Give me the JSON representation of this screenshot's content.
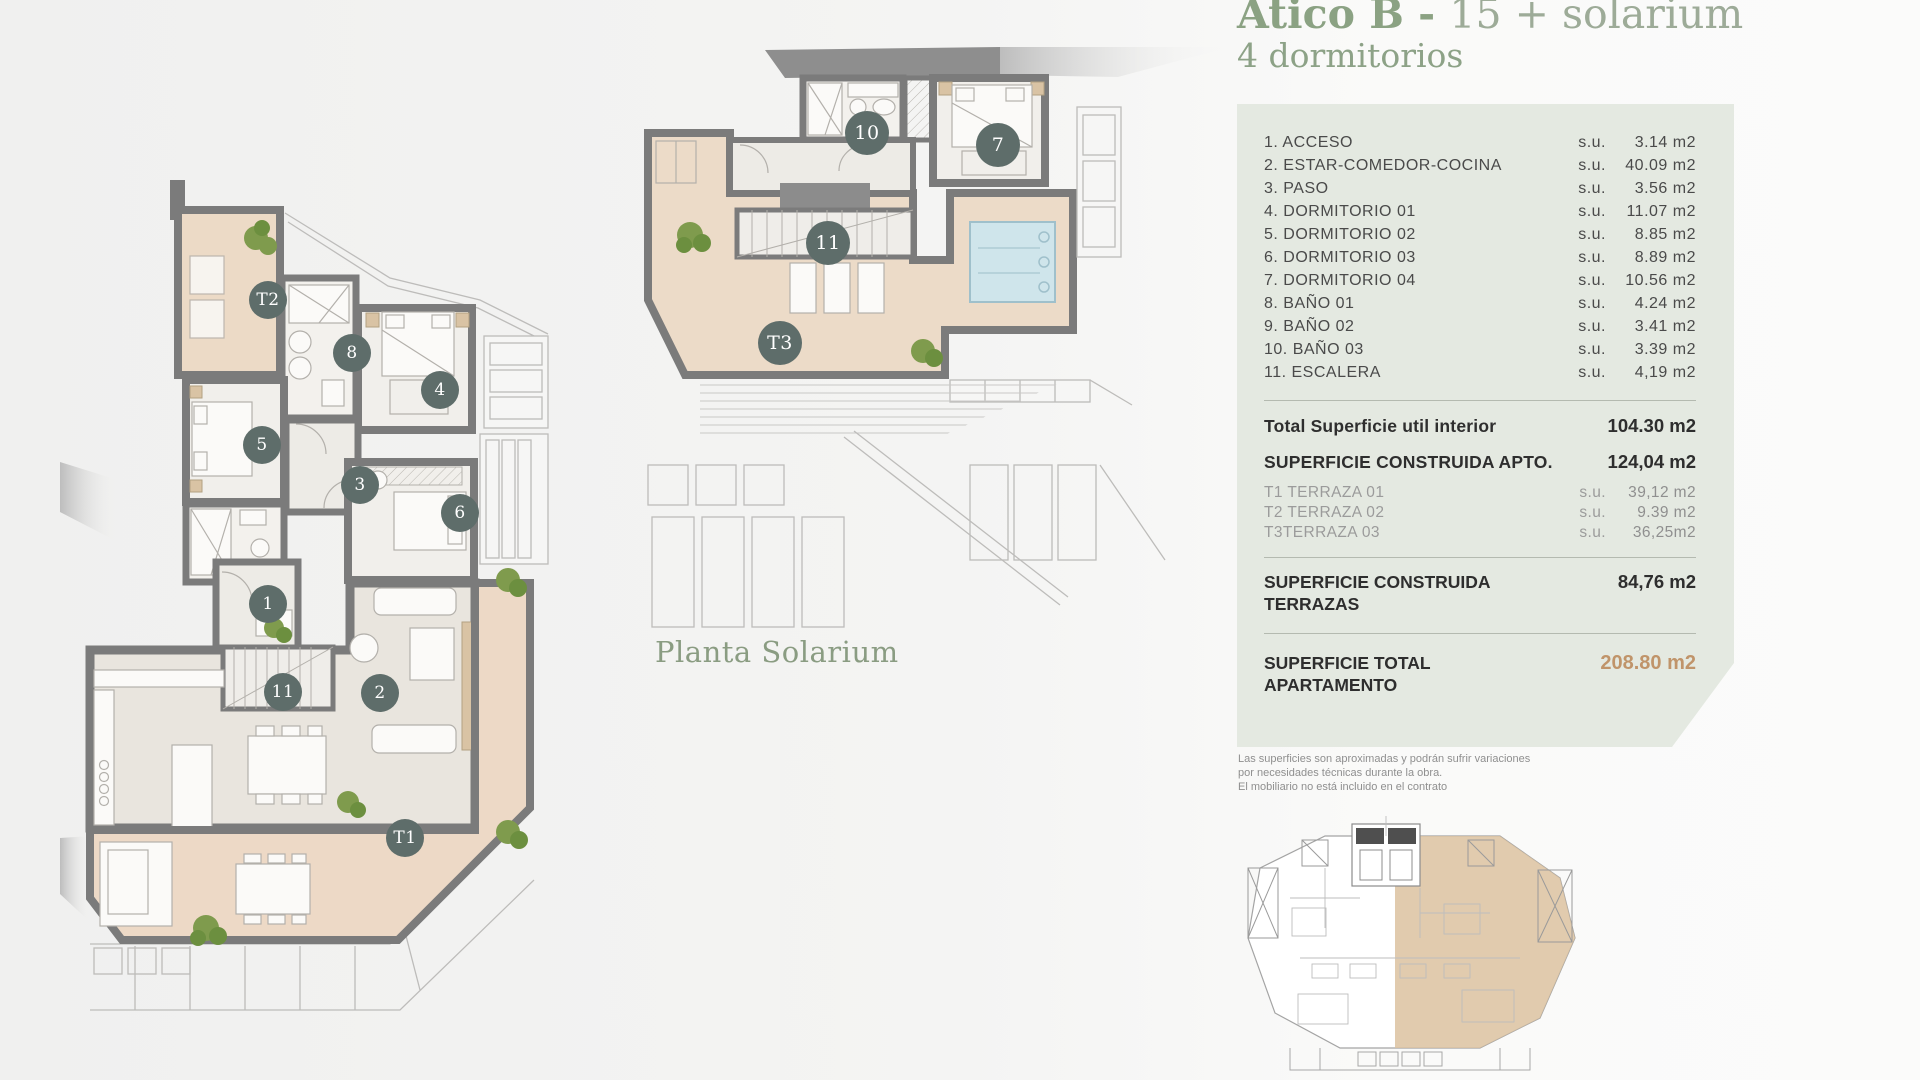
{
  "header": {
    "title_bold": "Ático B - ",
    "title_rest": "15 + solarium",
    "subtitle": "4 dormitorios"
  },
  "plans": {
    "main": {
      "markers": [
        "T2",
        "8",
        "4",
        "5",
        "3",
        "6",
        "1",
        "11",
        "2",
        "T1"
      ]
    },
    "solarium": {
      "caption": "Planta Solarium",
      "markers": [
        "10",
        "7",
        "11",
        "T3"
      ]
    }
  },
  "panel": {
    "rooms": [
      {
        "label": "1. ACCESO",
        "su": "s.u.",
        "value": "3.14 m2"
      },
      {
        "label": "2. ESTAR-COMEDOR-COCINA",
        "su": "s.u.",
        "value": "40.09 m2"
      },
      {
        "label": "3. PASO",
        "su": "s.u.",
        "value": "3.56 m2"
      },
      {
        "label": "4. DORMITORIO 01",
        "su": "s.u.",
        "value": "11.07 m2"
      },
      {
        "label": "5. DORMITORIO 02",
        "su": "s.u.",
        "value": "8.85 m2"
      },
      {
        "label": "6. DORMITORIO 03",
        "su": "s.u.",
        "value": "8.89 m2"
      },
      {
        "label": "7. DORMITORIO 04",
        "su": "s.u.",
        "value": "10.56 m2"
      },
      {
        "label": "8. BAÑO 01",
        "su": "s.u.",
        "value": "4.24 m2"
      },
      {
        "label": "9. BAÑO 02",
        "su": "s.u.",
        "value": "3.41 m2"
      },
      {
        "label": "10. BAÑO 03",
        "su": "s.u.",
        "value": "3.39 m2"
      },
      {
        "label": "11. ESCALERA",
        "su": "s.u.",
        "value": "4,19 m2"
      }
    ],
    "total_util": {
      "label": "Total Superficie util interior",
      "value": "104.30 m2"
    },
    "construida_apto": {
      "label": "SUPERFICIE CONSTRUIDA APTO.",
      "value": "124,04 m2"
    },
    "terrazas": [
      {
        "label": "T1 TERRAZA 01",
        "su": "s.u.",
        "value": "39,12 m2"
      },
      {
        "label": "T2 TERRAZA 02",
        "su": "s.u.",
        "value": "9.39 m2"
      },
      {
        "label": "T3TERRAZA 03",
        "su": "s.u.",
        "value": "36,25m2"
      }
    ],
    "construida_terrazas": {
      "line1": "SUPERFICIE CONSTRUIDA",
      "line2": "TERRAZAS",
      "value": "84,76 m2"
    },
    "total_apartamento": {
      "line1": "SUPERFICIE TOTAL",
      "line2": "APARTAMENTO",
      "value": "208.80 m2"
    }
  },
  "disclaimer": {
    "lines": [
      "Las superficies son aproximadas y podrán sufrir variaciones",
      "por necesidades técnicas durante la obra.",
      "El mobiliario no está incluido en el contrato"
    ]
  },
  "colors": {
    "accent_green": "#8ba283",
    "panel_background": "#e4e9e1",
    "marker_slate": "#5e6d6a",
    "terrace_tan": "#ecdac6",
    "pool_blue": "#cfe5eb",
    "total_gold": "#c0946a",
    "wall_gray": "#7b7b7b"
  }
}
